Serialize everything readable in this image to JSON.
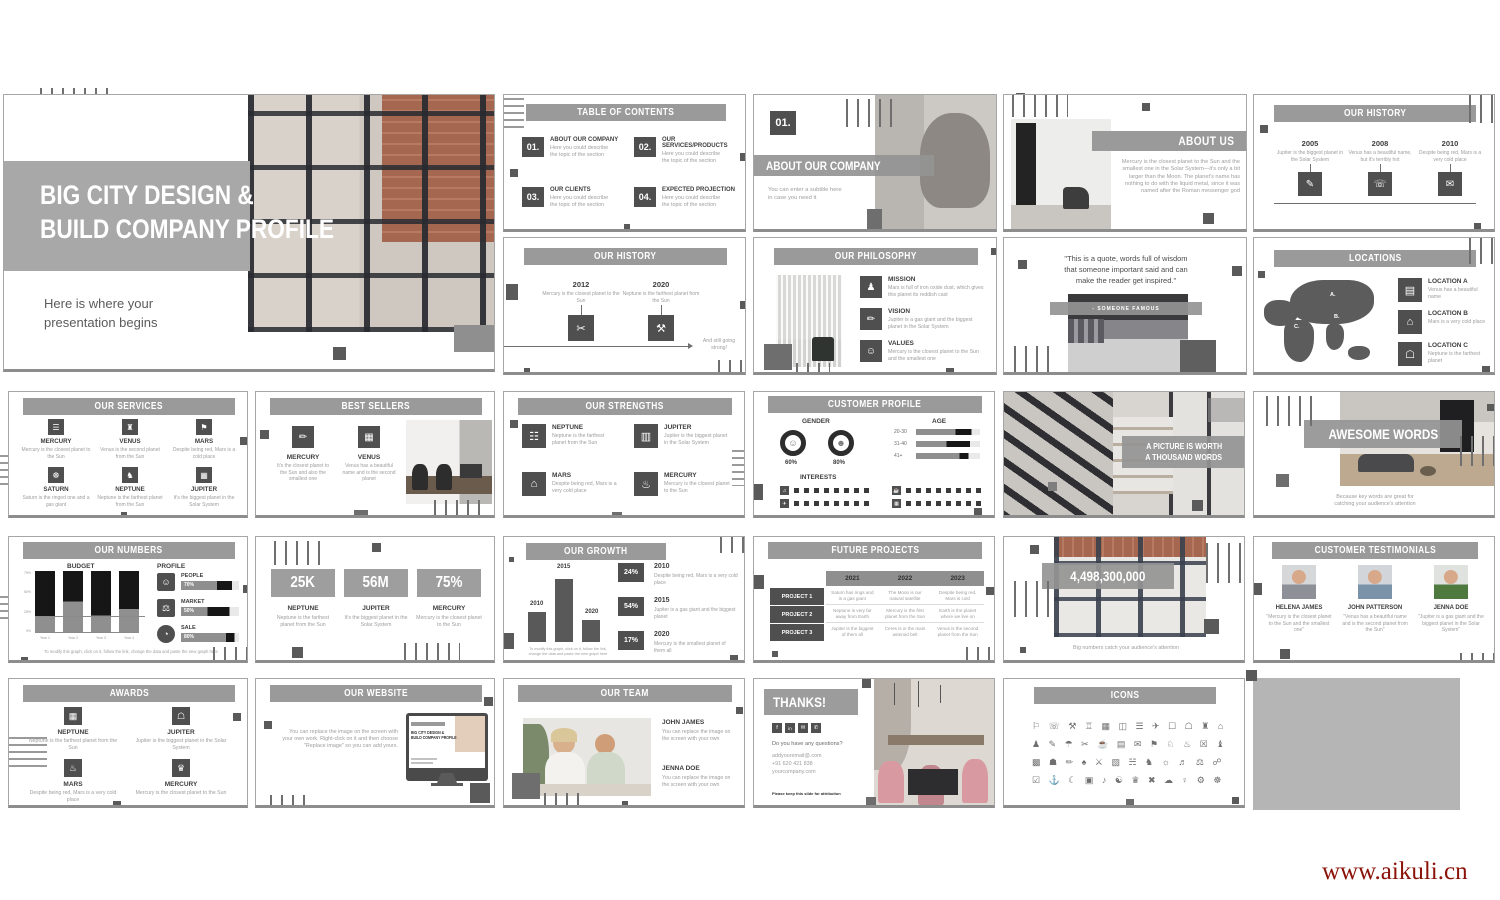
{
  "watermark": "www.aikuli.cn",
  "colors": {
    "banner": "#9a9a9a",
    "icon_box": "#4f4f4f",
    "heading": "#3d3d3d",
    "body_text": "#9d9d9d",
    "watermark": "#8a1208"
  },
  "slides": {
    "title": {
      "line1": "BIG CITY DESIGN &",
      "line2": "BUILD COMPANY PROFILE",
      "sub1": "Here is where your",
      "sub2": "presentation begins"
    },
    "toc": {
      "title": "TABLE OF CONTENTS",
      "items": [
        {
          "num": "01.",
          "label": "ABOUT OUR COMPANY",
          "desc": "Here you could describe the topic of the section"
        },
        {
          "num": "02.",
          "label": "OUR SERVICES/PRODUCTS",
          "desc": "Here you could describe the topic of the section"
        },
        {
          "num": "03.",
          "label": "OUR CLIENTS",
          "desc": "Here you could describe the topic of the section"
        },
        {
          "num": "04.",
          "label": "EXPECTED PROJECTION",
          "desc": "Here you could describe the topic of the section"
        }
      ]
    },
    "section01": {
      "num": "01.",
      "title": "ABOUT OUR COMPANY",
      "sub1": "You can enter a subtitle here",
      "sub2": "in case you need it"
    },
    "about": {
      "title": "ABOUT US",
      "body": "Mercury is the closest planet to the Sun and the smallest one in the Solar System—it's only a bit larger than the Moon. The planet's name has nothing to do with the liquid metal, since it was named after the Roman messenger god"
    },
    "history_a": {
      "title": "OUR HISTORY",
      "items": [
        {
          "year": "2005",
          "desc": "Jupiter is the biggest planet in the Solar System",
          "icon": "✎"
        },
        {
          "year": "2008",
          "desc": "Venus has a beautiful name, but it's terribly hot",
          "icon": "☏"
        },
        {
          "year": "2010",
          "desc": "Despite being red, Mars is a very cold place",
          "icon": "✉"
        }
      ]
    },
    "history_b": {
      "title": "OUR HISTORY",
      "items": [
        {
          "year": "2012",
          "desc": "Mercury is the closest planet to the Sun",
          "icon": "✂"
        },
        {
          "year": "2020",
          "desc": "Neptune is the farthest planet from the Sun",
          "icon": "⚒"
        }
      ],
      "tail": "And still going strong!"
    },
    "philosophy": {
      "title": "OUR PHILOSOPHY",
      "items": [
        {
          "label": "MISSION",
          "desc": "Mars is full of iron oxide dust, which gives this planet its reddish cast",
          "icon": "♟"
        },
        {
          "label": "VISION",
          "desc": "Jupiter is a gas giant and the biggest planet in the Solar System",
          "icon": "✏"
        },
        {
          "label": "VALUES",
          "desc": "Mercury is the closest planet to the Sun and the smallest one",
          "icon": "☺"
        }
      ]
    },
    "quote": {
      "line1": "\"This is a quote, words full of wisdom",
      "line2": "that someone important said and can",
      "line3": "make the reader get inspired.\"",
      "attribution": "- SOMEONE FAMOUS"
    },
    "locations": {
      "title": "LOCATIONS",
      "markers": [
        "A.",
        "B.",
        "C."
      ],
      "items": [
        {
          "label": "LOCATION A",
          "desc": "Venus has a beautiful name",
          "icon": "▤"
        },
        {
          "label": "LOCATION B",
          "desc": "Mars is a very cold place",
          "icon": "⌂"
        },
        {
          "label": "LOCATION C",
          "desc": "Neptune is the farthest planet",
          "icon": "☖"
        }
      ]
    },
    "services": {
      "title": "OUR SERVICES",
      "items": [
        {
          "label": "MERCURY",
          "desc": "Mercury is the closest planet to the Sun",
          "icon": "☰"
        },
        {
          "label": "VENUS",
          "desc": "Venus is the second planet from the Sun",
          "icon": "♜"
        },
        {
          "label": "MARS",
          "desc": "Despite being red, Mars is a cold place",
          "icon": "⚑"
        },
        {
          "label": "SATURN",
          "desc": "Saturn is the ringed one and a gas giant",
          "icon": "☸"
        },
        {
          "label": "NEPTUNE",
          "desc": "Neptune is the farthest planet from the Sun",
          "icon": "♞"
        },
        {
          "label": "JUPITER",
          "desc": "It's the biggest planet in the Solar System",
          "icon": "▦"
        }
      ]
    },
    "best": {
      "title": "BEST SELLERS",
      "items": [
        {
          "label": "MERCURY",
          "desc": "It's the closest planet to the Sun and also the smallest one",
          "icon": "✏"
        },
        {
          "label": "VENUS",
          "desc": "Venus has a beautiful name and is the second planet",
          "icon": "▦"
        }
      ]
    },
    "strengths": {
      "title": "OUR STRENGTHS",
      "items": [
        {
          "label": "NEPTUNE",
          "desc": "Neptune is the farthest planet from the Sun",
          "icon": "☷"
        },
        {
          "label": "JUPITER",
          "desc": "Jupiter is the biggest planet in the Solar System",
          "icon": "▥"
        },
        {
          "label": "MARS",
          "desc": "Despite being red, Mars is a very cold place",
          "icon": "⌂"
        },
        {
          "label": "MERCURY",
          "desc": "Mercury is the closest planet to the Sun",
          "icon": "♨"
        }
      ]
    },
    "profile": {
      "title": "CUSTOMER PROFILE",
      "gender_label": "GENDER",
      "genders": [
        {
          "value": "60%",
          "icon": "☺"
        },
        {
          "value": "80%",
          "icon": "☻"
        }
      ],
      "age_label": "AGE",
      "ages": [
        {
          "label": "20-30",
          "bar": [
            62,
            25
          ]
        },
        {
          "label": "31-40",
          "bar": [
            48,
            36
          ]
        },
        {
          "label": "41+",
          "bar": [
            68,
            14
          ]
        }
      ],
      "interests_label": "INTERESTS",
      "interest_icons": [
        "♫",
        "✈",
        "☕",
        "▦"
      ]
    },
    "picture": {
      "line1": "A PICTURE IS WORTH",
      "line2": "A THOUSAND WORDS"
    },
    "awesome": {
      "title": "AWESOME WORDS",
      "cap1": "Because key words are great for",
      "cap2": "catching your audience's attention"
    },
    "numbers": {
      "title": "OUR NUMBERS",
      "budget_label": "BUDGET",
      "profile_label": "PROFILE",
      "budget_black": [
        75,
        50,
        73,
        62
      ],
      "y_ticks": [
        "75%",
        "50%",
        "25%",
        "0%"
      ],
      "x_ticks": [
        "Year 1",
        "Year 2",
        "Year 3",
        "Year 4"
      ],
      "profile_items": [
        {
          "label": "PEOPLE",
          "value": "70%",
          "icon": "☺",
          "bar": [
            62,
            26
          ]
        },
        {
          "label": "MARKET",
          "value": "50%",
          "icon": "⚖",
          "bar": [
            46,
            38
          ]
        },
        {
          "label": "SALE",
          "value": "80%",
          "icon": "◔",
          "bar": [
            78,
            14
          ]
        }
      ],
      "note": "To modify this graph, click on it, follow the link, change the data and paste the new graph here"
    },
    "big3": {
      "items": [
        {
          "value": "25K",
          "label": "NEPTUNE",
          "desc": "Neptune is the farthest planet from the Sun"
        },
        {
          "value": "56M",
          "label": "JUPITER",
          "desc": "It's the biggest planet in the Solar System"
        },
        {
          "value": "75%",
          "label": "MERCURY",
          "desc": "Mercury is the closest planet to the Sun"
        }
      ]
    },
    "growth": {
      "title": "OUR GROWTH",
      "years": [
        "2010",
        "2015",
        "2020"
      ],
      "heights": [
        48,
        100,
        35
      ],
      "items": [
        {
          "pct": "24%",
          "year": "2010",
          "desc": "Despite being red, Mars is a very cold place"
        },
        {
          "pct": "54%",
          "year": "2015",
          "desc": "Jupiter is a gas giant and the biggest planet"
        },
        {
          "pct": "17%",
          "year": "2020",
          "desc": "Mercury is the smallest planet of them all"
        }
      ],
      "note": "To modify this graph, click on it, follow the link, change the data and paste the new graph here"
    },
    "future": {
      "title": "FUTURE PROJECTS",
      "years": [
        "2021",
        "2022",
        "2023"
      ],
      "rows": [
        {
          "label": "PROJECT 1",
          "cells": [
            "Saturn has rings and is a gas giant",
            "The Moon is our natural satellite",
            "Despite being red, Mars is cold"
          ]
        },
        {
          "label": "PROJECT 2",
          "cells": [
            "Neptune is very far away from Earth",
            "Mercury is the first planet from the Sun",
            "Earth is the planet where we live on"
          ]
        },
        {
          "label": "PROJECT 3",
          "cells": [
            "Jupiter is the biggest of them all",
            "Ceres is in the main asteroid belt",
            "Venus is the second planet from the Sun"
          ]
        }
      ]
    },
    "bignum": {
      "value": "4,498,300,000",
      "caption": "Big numbers catch your audience's attention"
    },
    "testimonials": {
      "title": "CUSTOMER TESTIMONIALS",
      "items": [
        {
          "name": "HELENA JAMES",
          "quote": "\"Mercury is the closest planet to the Sun and the smallest one\""
        },
        {
          "name": "JOHN PATTERSON",
          "quote": "\"Venus has a beautiful name and is the second planet from the Sun\""
        },
        {
          "name": "JENNA DOE",
          "quote": "\"Jupiter is a gas giant and the biggest planet in the Solar System\""
        }
      ]
    },
    "awards": {
      "title": "AWARDS",
      "items": [
        {
          "label": "NEPTUNE",
          "desc": "Neptune is the farthest planet from the Sun",
          "icon": "▦"
        },
        {
          "label": "JUPITER",
          "desc": "Jupiter is the biggest planet in the Solar System",
          "icon": "☖"
        },
        {
          "label": "MARS",
          "desc": "Despite being red, Mars is a very cold place",
          "icon": "♨"
        },
        {
          "label": "MERCURY",
          "desc": "Mercury is the closest planet to the Sun",
          "icon": "♛"
        }
      ]
    },
    "website": {
      "title": "OUR WEBSITE",
      "body": "You can replace the image on the screen with your own work. Right-click on it and then choose \"Replace image\" so you can add yours.",
      "scr1": "BIG CITY DESIGN &",
      "scr2": "BUILD COMPANY PROFILE"
    },
    "team": {
      "title": "OUR TEAM",
      "members": [
        {
          "name": "JOHN JAMES",
          "desc": "You can replace the image on the screen with your own"
        },
        {
          "name": "JENNA DOE",
          "desc": "You can replace the image on the screen with your own"
        }
      ]
    },
    "thanks": {
      "title": "THANKS!",
      "social": [
        "f",
        "in",
        "✉",
        "✆"
      ],
      "question": "Do you have any questions?",
      "email": "addyouremail@.com",
      "phone": "+91 620 421 838",
      "web": "yourcompany.com",
      "attribution": "Please keep this slide for attribution"
    },
    "icons": {
      "title": "ICONS",
      "rows": [
        "⚐ ☏ ⚒ ♖ ▦ ◫ ☰ ✈ ☐ ☖ ♜ ⌂",
        "♟ ✎ ☂ ✂ ☕ ▤ ✉ ⚑ ♘ ♨ ☒ ♝",
        "▩ ☗ ✏ ♠ ⚔ ▧ ☵ ♞ ☼ ♬ ⚖ ☍",
        "☑ ⚓ ☾ ▣ ♪ ☯ ♛ ✖ ☁ ♀ ⚙ ☸"
      ]
    }
  }
}
